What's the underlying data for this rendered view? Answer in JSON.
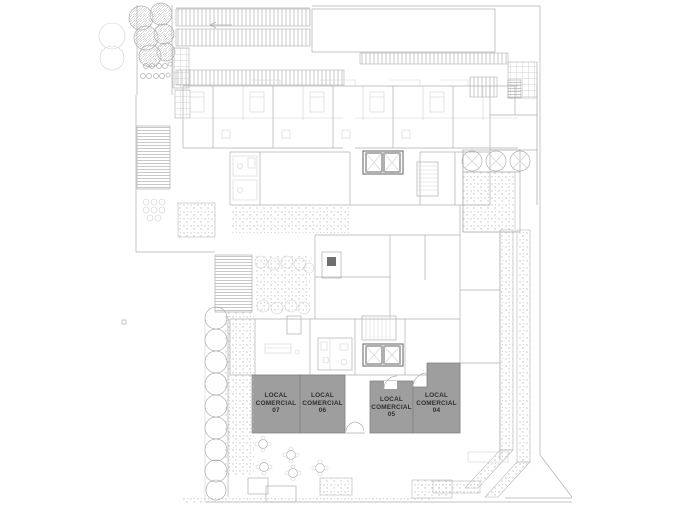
{
  "plan": {
    "title": "ground-floor-site-plan",
    "units": [
      {
        "id": "local-comercial-07",
        "lines": [
          "LOCAL",
          "COMERCIAL",
          "07"
        ]
      },
      {
        "id": "local-comercial-06",
        "lines": [
          "LOCAL",
          "COMERCIAL",
          "06"
        ]
      },
      {
        "id": "local-comercial-05",
        "lines": [
          "LOCAL",
          "COMERCIAL",
          "05"
        ]
      },
      {
        "id": "local-comercial-04",
        "lines": [
          "LOCAL",
          "COMERCIAL",
          "04"
        ]
      }
    ],
    "colors": {
      "unit_fill": "#9e9e9e",
      "unit_border": "#808080",
      "unit_text": "#2f2f2f",
      "line_light": "#d2d2d2",
      "line_mid": "#b0b0b0",
      "line_dark": "#6f6f6f",
      "stipple": "#c2c2c2",
      "hatch": "#bababa",
      "bg": "#ffffff"
    }
  }
}
